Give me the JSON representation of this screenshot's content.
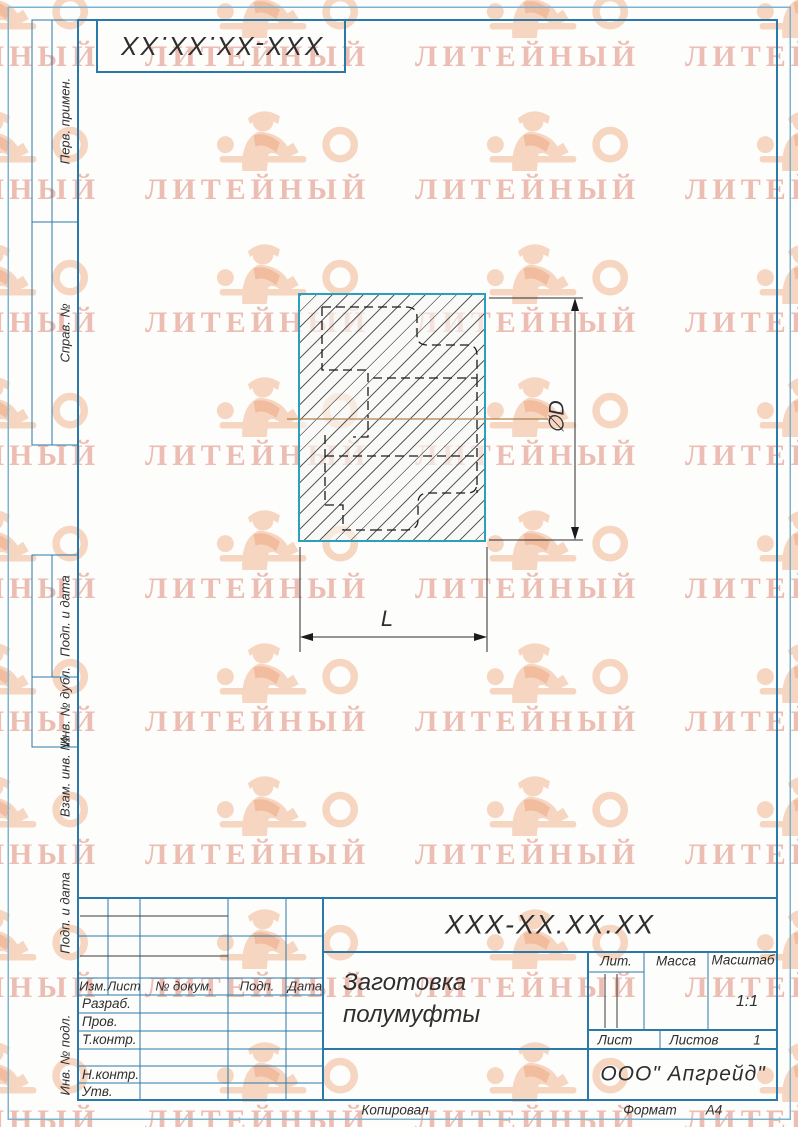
{
  "watermark": {
    "text": "ЛИТЕЙНЫЙ"
  },
  "corner_stamp": {
    "designation": "XXX-XX.XX.XX"
  },
  "sidebar": {
    "items": [
      {
        "label": "Перв. примен."
      },
      {
        "label": "Справ. №"
      },
      {
        "label": "Подп. и дата"
      },
      {
        "label": "Инв. № дубл."
      },
      {
        "label": "Взам. инв. №"
      },
      {
        "label": "Подп. и дата"
      },
      {
        "label": "Инв. № подл."
      }
    ]
  },
  "drawing": {
    "diameter_label": "∅D",
    "length_label": "L"
  },
  "title_block": {
    "designation": "XXX-XX.XX.XX",
    "part_name_line1": "Заготовка",
    "part_name_line2": "полумуфты",
    "company": "ООО\" Апгрейд\"",
    "header": {
      "izm": "Изм.",
      "list": "Лист",
      "dokum": "№ докум.",
      "podp": "Подп.",
      "data": "Дата"
    },
    "rows": {
      "razrab": "Разраб.",
      "prov": "Пров.",
      "tkontr": "Т.контр.",
      "nkontr": "Н.контр.",
      "utv": "Утв."
    },
    "lit_label": "Лит.",
    "massa_label": "Масса",
    "masshtab_label": "Масштаб",
    "scale_value": "1:1",
    "list_label": "Лист",
    "listov_label": "Листов",
    "listov_value": "1"
  },
  "footer": {
    "kopiroval": "Копировал",
    "format_label": "Формат",
    "format_value": "А4"
  },
  "colors": {
    "frame": "#2b79a8",
    "part_outline": "#2aa0bc",
    "centerline": "#b08350",
    "watermark_text": "#e9aea2",
    "watermark_figure": "#f2b892"
  }
}
